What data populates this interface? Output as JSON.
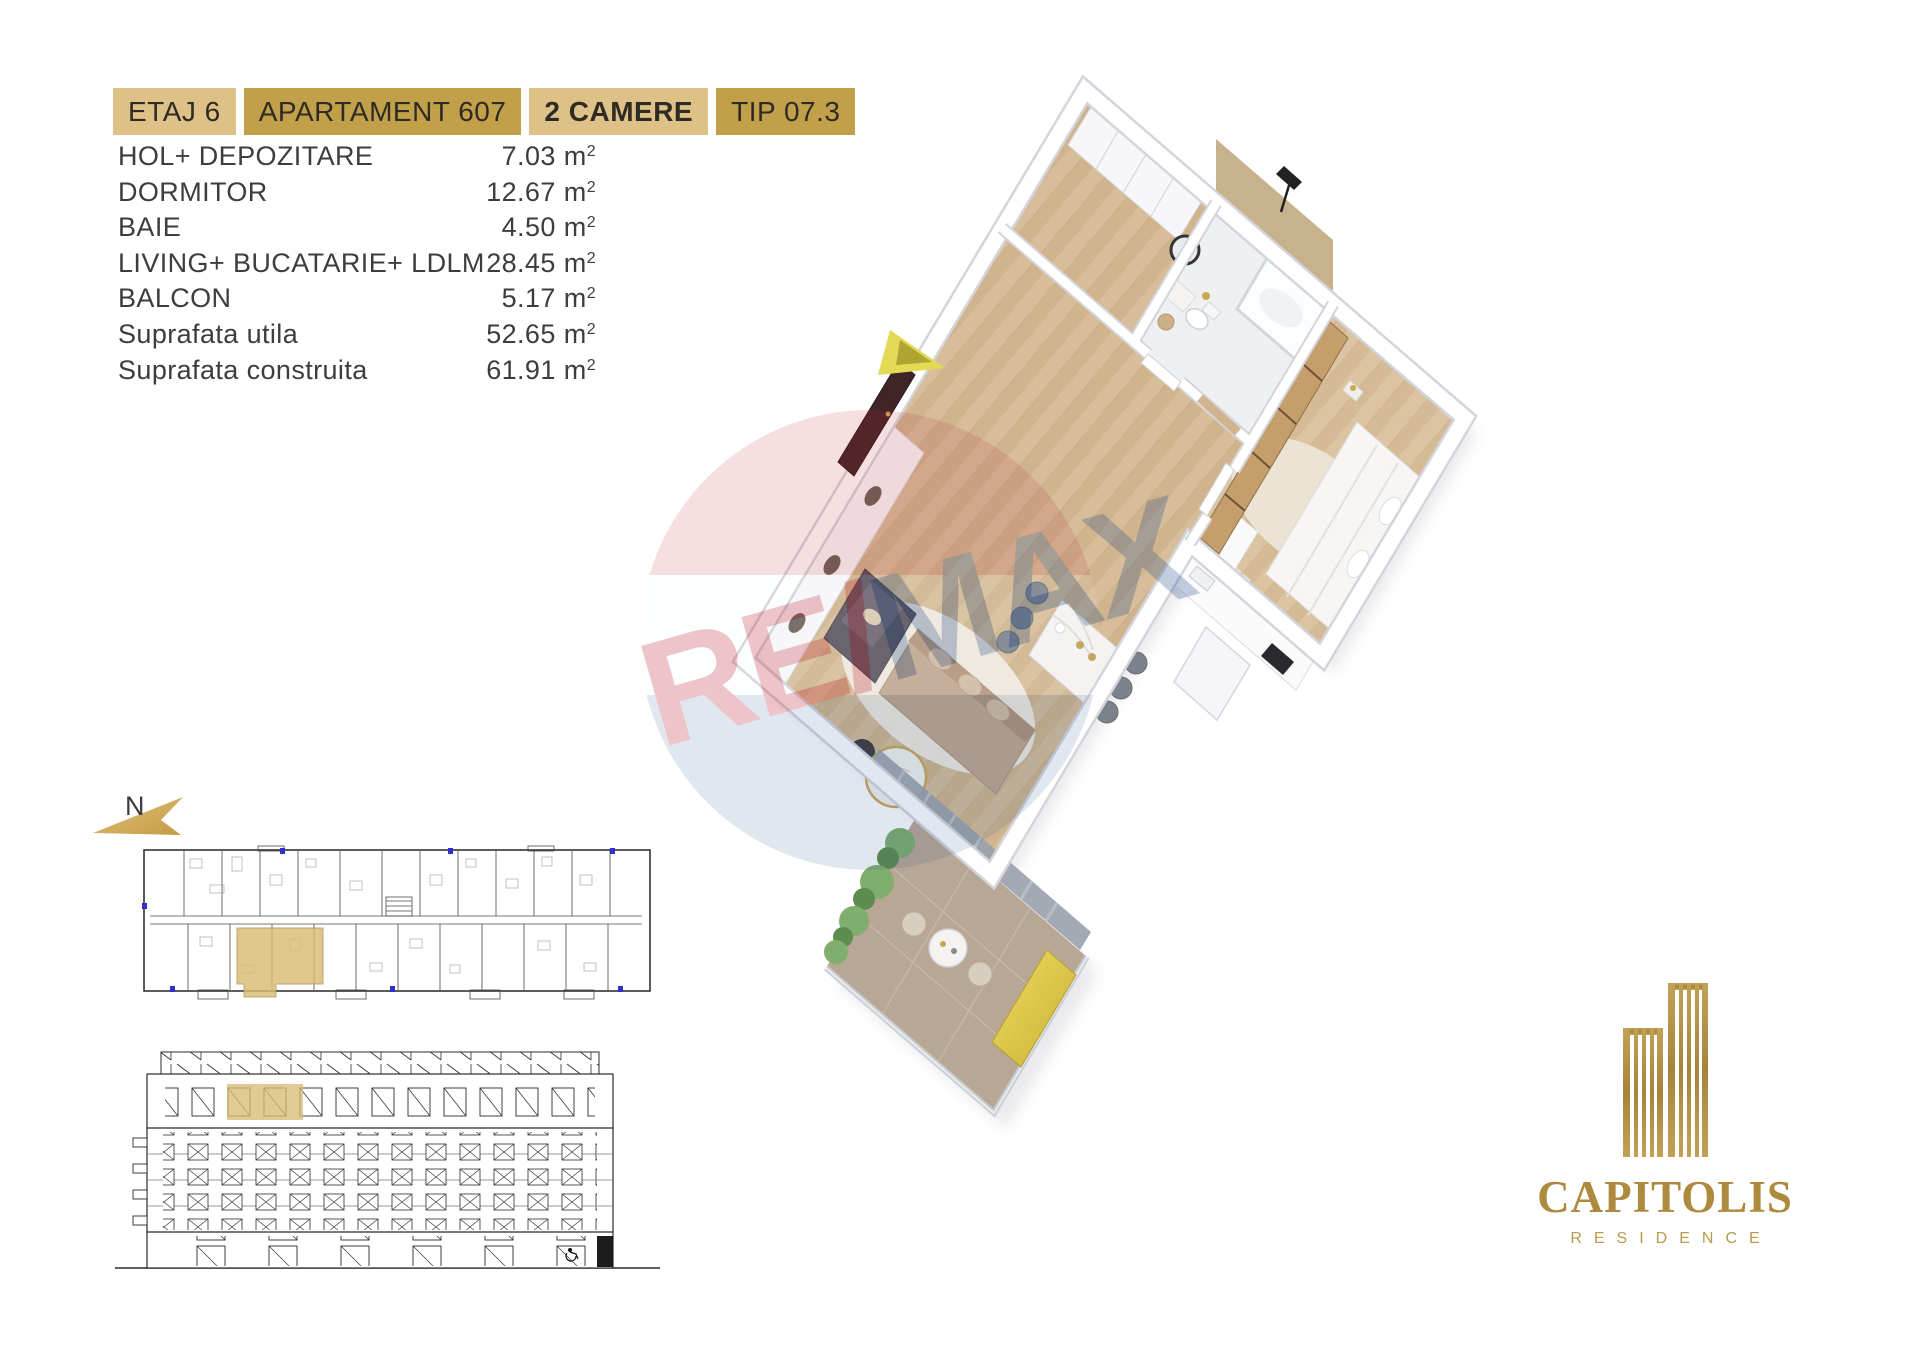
{
  "header": {
    "badges": [
      {
        "label": "ETAJ 6"
      },
      {
        "label": "APARTAMENT 607"
      },
      {
        "label": "2 CAMERE"
      },
      {
        "label": "TIP 07.3"
      }
    ]
  },
  "areas": {
    "unit": "m",
    "sup": "2",
    "rows": [
      {
        "label": "HOL+ DEPOZITARE",
        "value": "7.03"
      },
      {
        "label": "DORMITOR",
        "value": "12.67"
      },
      {
        "label": "BAIE",
        "value": "4.50"
      },
      {
        "label": "LIVING+ BUCATARIE+ LDLM",
        "value": "28.45"
      },
      {
        "label": "BALCON",
        "value": "5.17"
      },
      {
        "label": "Suprafata utila",
        "value": "52.65"
      },
      {
        "label": "Suprafata construita",
        "value": "61.91"
      }
    ]
  },
  "compass": {
    "label": "N"
  },
  "watermark": {
    "re": "RE",
    "slash": "/",
    "max": "MAX"
  },
  "logo": {
    "name": "CAPITOLIS",
    "tagline": "RESIDENCE"
  },
  "colors": {
    "badge_light": "#ddc186",
    "badge_dark": "#c2a04a",
    "unit_highlight": "#d9bd76",
    "logo_gold": "#ad8a3e",
    "remax_red": "#c23040",
    "remax_blue": "#27508c",
    "balcony_bench_gold": "#e3c94e"
  }
}
